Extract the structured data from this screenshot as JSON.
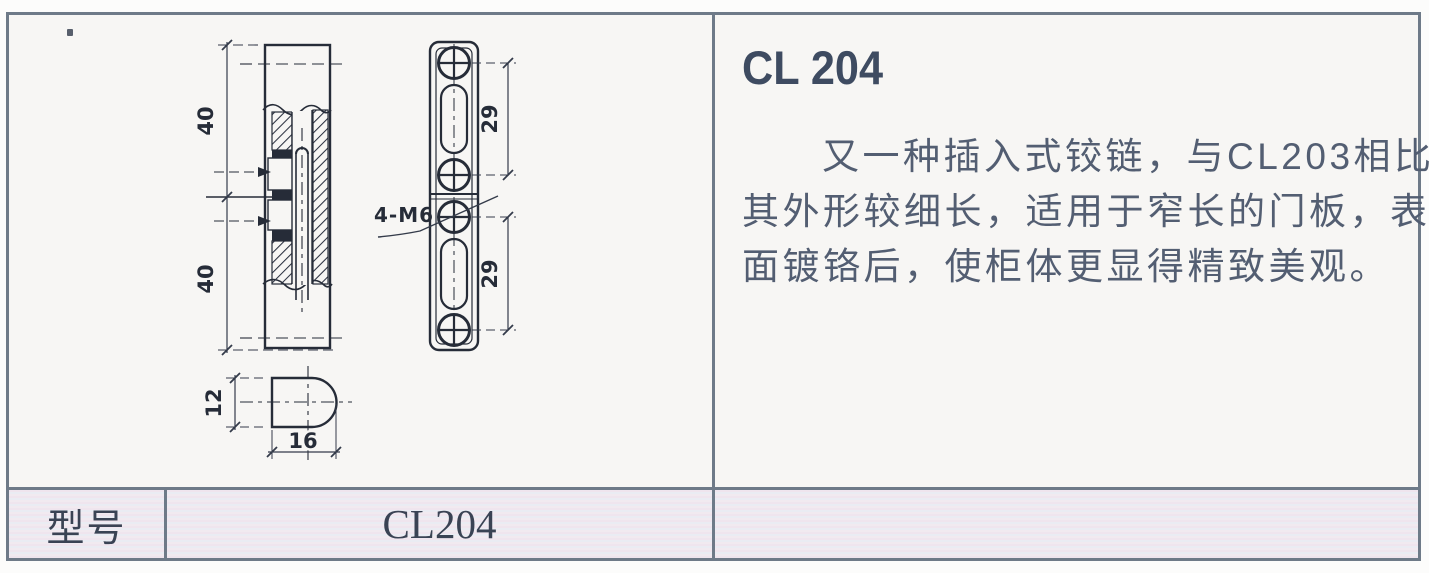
{
  "product": {
    "title": "CL 204",
    "description_lines": [
      "又一种插入式铰链，与CL203相比，",
      "其外形较细长，适用于窄长的门板，表",
      "面镀铬后，使柜体更显得精致美观。"
    ]
  },
  "drawing": {
    "dim_side_upper": "40",
    "dim_side_lower": "40",
    "dim_plate_upper": "29",
    "dim_plate_lower": "29",
    "dim_end_height": "12",
    "dim_end_width": "16",
    "thread_callout": "4-M6"
  },
  "spec_table": {
    "model_label": "型号",
    "model_value": "CL204"
  },
  "colors": {
    "frame_border": "#6e7a88",
    "drawing_line": "#262c38",
    "dim_line": "#343b4a",
    "title_text": "#3e4b61",
    "body_text": "#535e72",
    "table_text": "#3a4354",
    "table_stripe_pink": "#efe5ee",
    "table_stripe_blue": "#eaecf3",
    "panel_background": "#f7f6f4"
  }
}
